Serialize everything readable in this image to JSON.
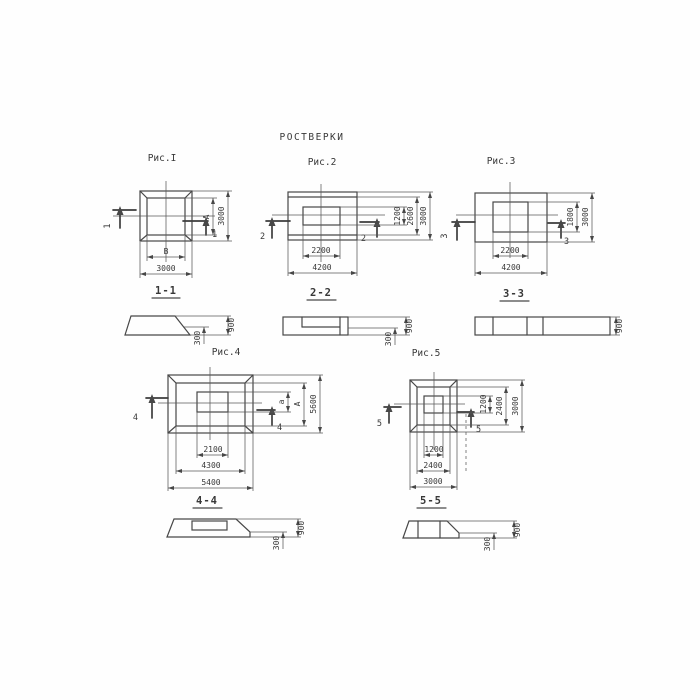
{
  "title": "РОСТВЕРКИ",
  "fig1": {
    "label": "Рис.I",
    "section_mark": "1",
    "plan_dims": {
      "inner_vertical": "A",
      "outer_vertical": "3000",
      "inner_horizontal": "В",
      "outer_horizontal": "3000"
    },
    "section_title": "1-1",
    "section_dims": {
      "total_height": "900",
      "edge_height": "300"
    }
  },
  "fig2": {
    "label": "Рис.2",
    "section_mark": "2",
    "plan_dims": {
      "v_inner": "1200",
      "v_middle": "2600",
      "v_outer": "3000",
      "h_inner": "2200",
      "h_outer": "4200"
    },
    "section_title": "2-2",
    "section_dims": {
      "total_height": "900",
      "edge_height": "300"
    }
  },
  "fig3": {
    "label": "Рис.3",
    "section_mark": "3",
    "plan_dims": {
      "v_inner": "1800",
      "v_outer": "3000",
      "h_inner": "2200",
      "h_outer": "4200"
    },
    "section_title": "3-3",
    "section_dims": {
      "total_height": "900"
    }
  },
  "fig4": {
    "label": "Рис.4",
    "section_mark": "4",
    "plan_dims": {
      "v_inner": "а",
      "v_middle": "А",
      "v_outer": "5600",
      "h_inner": "2100",
      "h_middle": "4300",
      "h_outer": "5400"
    },
    "section_title": "4-4",
    "section_dims": {
      "total_height": "900",
      "edge_height": "300"
    }
  },
  "fig5": {
    "label": "Рис.5",
    "section_mark": "5",
    "plan_dims": {
      "v_inner": "1200",
      "v_middle": "2400",
      "v_outer": "3000",
      "h_inner": "1200",
      "h_middle": "2400",
      "h_outer": "3000"
    },
    "section_title": "5-5",
    "section_dims": {
      "total_height": "900",
      "edge_height": "300"
    }
  }
}
